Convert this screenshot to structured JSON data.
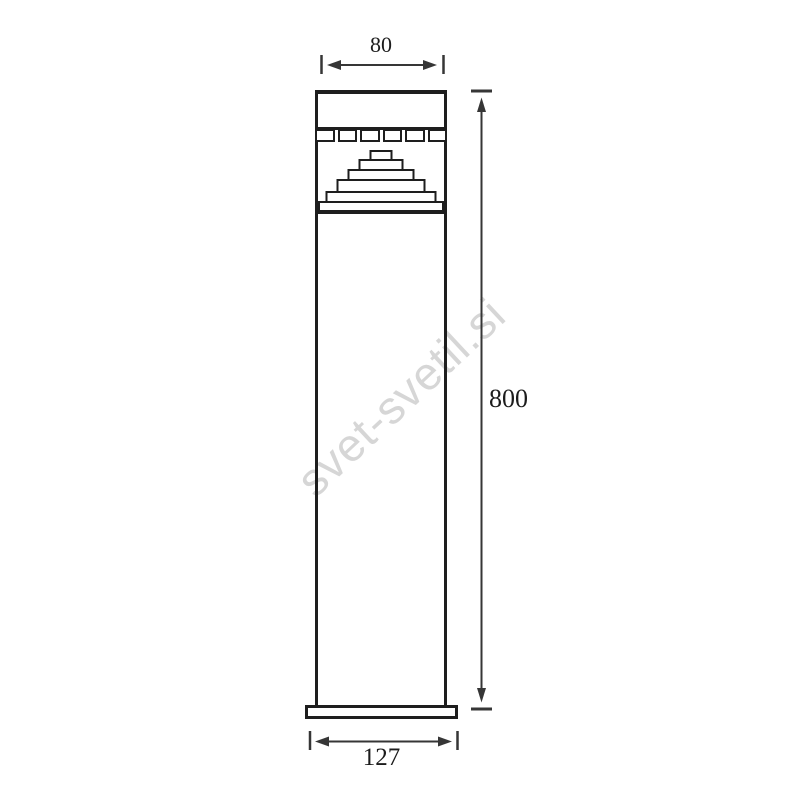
{
  "meta": {
    "type": "technical-dimension-drawing",
    "subject": "bollard luminaire, front elevation"
  },
  "watermark": {
    "text": "svet-svetil.si",
    "rotation_deg": -43
  },
  "colors": {
    "line": "#1e1e1e",
    "dim": "#363636",
    "text": "#1c1c1c",
    "watermark": "#d6d6d6",
    "bg": "#ffffff"
  },
  "drawing": {
    "parts": [
      "head-cap",
      "louver-row-6-cells",
      "stepped-reflector-6-tiers",
      "shaft",
      "base-plate"
    ]
  },
  "dimensions": {
    "top": {
      "label": "80",
      "orientation": "horizontal",
      "position": "above head"
    },
    "right": {
      "label": "800",
      "orientation": "vertical",
      "position": "right of body"
    },
    "bottom": {
      "label": "127",
      "orientation": "horizontal",
      "position": "below base plate"
    }
  }
}
